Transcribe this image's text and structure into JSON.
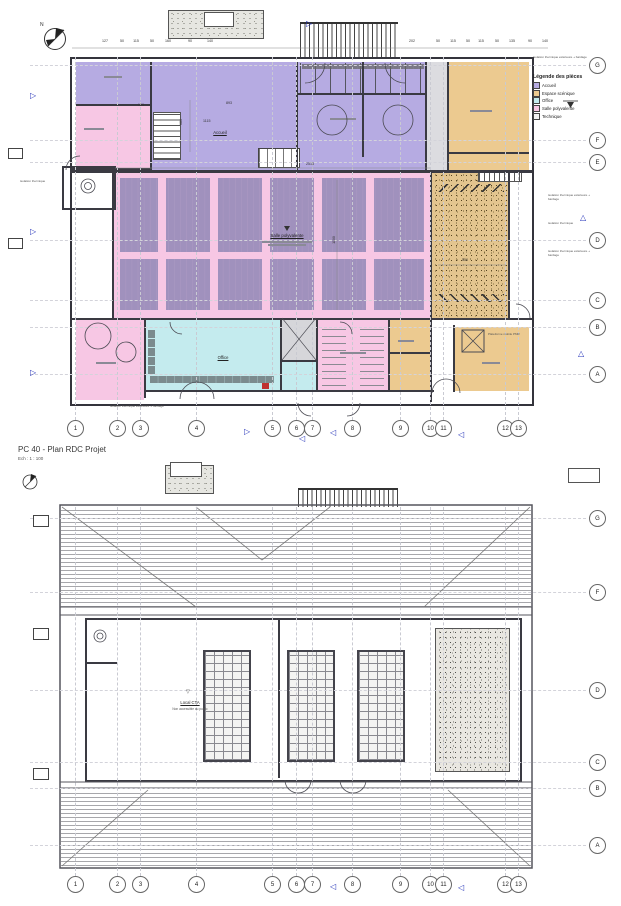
{
  "title_block": {
    "title": "PC 40 - Plan RDC Projet",
    "scale": "Ech :  1 : 100"
  },
  "compass": {
    "north": "N"
  },
  "legend": {
    "title": "Légende des pièces",
    "items": [
      {
        "label": "Accueil",
        "color": "#b6abe2"
      },
      {
        "label": "Espace scénique",
        "color": "#ecca90"
      },
      {
        "label": "Office",
        "color": "#c4ebee"
      },
      {
        "label": "Salle polyvalente",
        "color": "#f7c7e4"
      },
      {
        "label": "Technique",
        "color": "#f2f2f2"
      }
    ]
  },
  "grid": {
    "columns": [
      "1",
      "2",
      "3",
      "4",
      "5",
      "6",
      "7",
      "8",
      "9",
      "10",
      "11",
      "12",
      "13"
    ],
    "rows": [
      "G",
      "F",
      "E",
      "D",
      "C",
      "B",
      "A"
    ],
    "roof_rows": [
      "G",
      "F",
      "D",
      "C",
      "B",
      "A"
    ]
  },
  "dimensions": {
    "top": [
      "127",
      "50",
      "115",
      "50",
      "160",
      "90",
      "140",
      "202",
      "50",
      "115",
      "50",
      "115",
      "50",
      "135",
      "90",
      "140"
    ],
    "interior": {
      "w1": "160",
      "w2": "893",
      "w3": "1115",
      "h1": "680",
      "hall_w": "2513",
      "hall_h": "1100",
      "scene_w": "550"
    }
  },
  "rooms": {
    "hall": "Salle polyvalente",
    "accueil": "Accueil",
    "office": "Office"
  },
  "annotations": {
    "pmr": "Plateforme mobile PMR",
    "iso1": "isolation thermique extérieure + bardage",
    "iso2": "isolation thermique",
    "cta1": "Local CTA",
    "cta2": "Non accessible au public"
  }
}
